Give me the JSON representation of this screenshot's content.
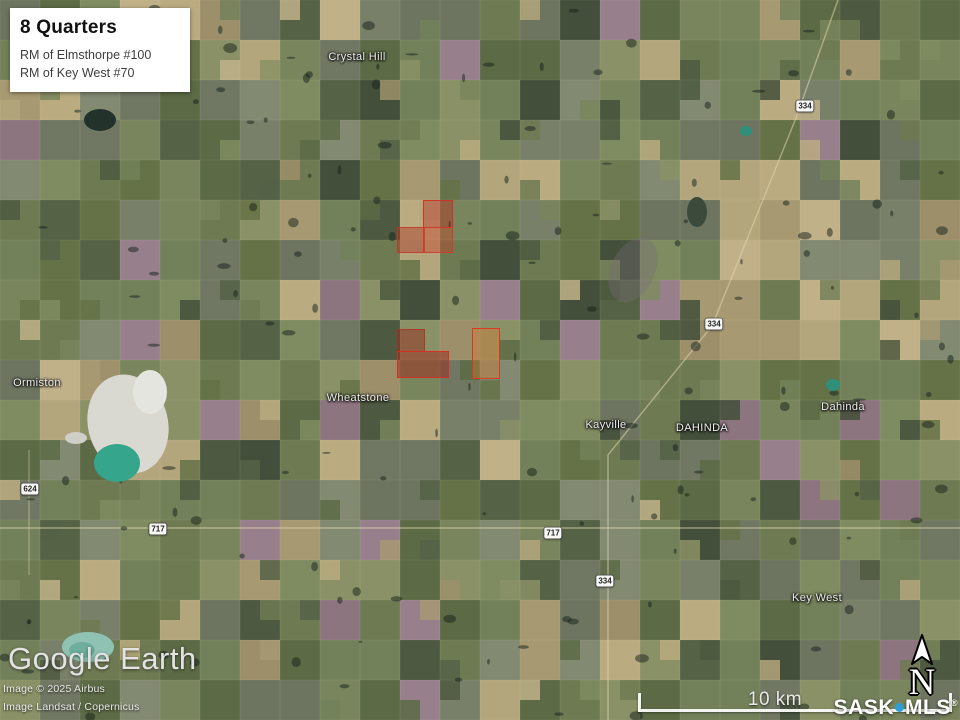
{
  "title_card": {
    "title": "8 Quarters",
    "lines": [
      "RM of Elmsthorpe #100",
      "RM of Key West #70"
    ]
  },
  "place_labels": [
    {
      "text": "Crystal Hill",
      "x": 357,
      "y": 57
    },
    {
      "text": "Ormiston",
      "x": 37,
      "y": 383
    },
    {
      "text": "Wheatstone",
      "x": 358,
      "y": 398
    },
    {
      "text": "Kayville",
      "x": 606,
      "y": 425
    },
    {
      "text": "DAHINDA",
      "x": 702,
      "y": 428
    },
    {
      "text": "Dahinda",
      "x": 843,
      "y": 407
    },
    {
      "text": "Key West",
      "x": 817,
      "y": 598
    }
  ],
  "road_shields": [
    {
      "text": "334",
      "x": 805,
      "y": 106
    },
    {
      "text": "334",
      "x": 714,
      "y": 324
    },
    {
      "text": "624",
      "x": 30,
      "y": 489
    },
    {
      "text": "717",
      "x": 158,
      "y": 529
    },
    {
      "text": "717",
      "x": 553,
      "y": 533
    },
    {
      "text": "334",
      "x": 605,
      "y": 581
    }
  ],
  "parcels": [
    {
      "x": 423,
      "y": 200,
      "w": 30,
      "h": 28,
      "fill": "rgba(190,35,25,0.38)",
      "stroke": "rgba(210,45,30,0.85)"
    },
    {
      "x": 397,
      "y": 227,
      "w": 27,
      "h": 26,
      "fill": "rgba(170,45,30,0.42)",
      "stroke": "rgba(205,50,35,0.8)"
    },
    {
      "x": 424,
      "y": 227,
      "w": 29,
      "h": 26,
      "fill": "rgba(200,60,35,0.40)",
      "stroke": "rgba(215,55,35,0.85)"
    },
    {
      "x": 397,
      "y": 329,
      "w": 28,
      "h": 23,
      "fill": "rgba(150,35,25,0.45)",
      "stroke": "rgba(180,45,30,0.7)"
    },
    {
      "x": 397,
      "y": 351,
      "w": 52,
      "h": 27,
      "fill": "rgba(160,35,25,0.48)",
      "stroke": "rgba(220,45,30,0.9)"
    },
    {
      "x": 472,
      "y": 328,
      "w": 28,
      "h": 51,
      "fill": "rgba(220,120,50,0.38)",
      "stroke": "rgba(220,55,30,0.95)"
    }
  ],
  "attribution": {
    "logo": "Google Earth",
    "credits": [
      "Image © 2025 Airbus",
      "Image Landsat / Copernicus"
    ]
  },
  "scale_bar": {
    "label": "10 km"
  },
  "compass": {
    "letter": "N"
  },
  "brand": {
    "sask": "SASK",
    "mls": "MLS",
    "registered": "®",
    "dot_color": "#2e9fd4"
  }
}
